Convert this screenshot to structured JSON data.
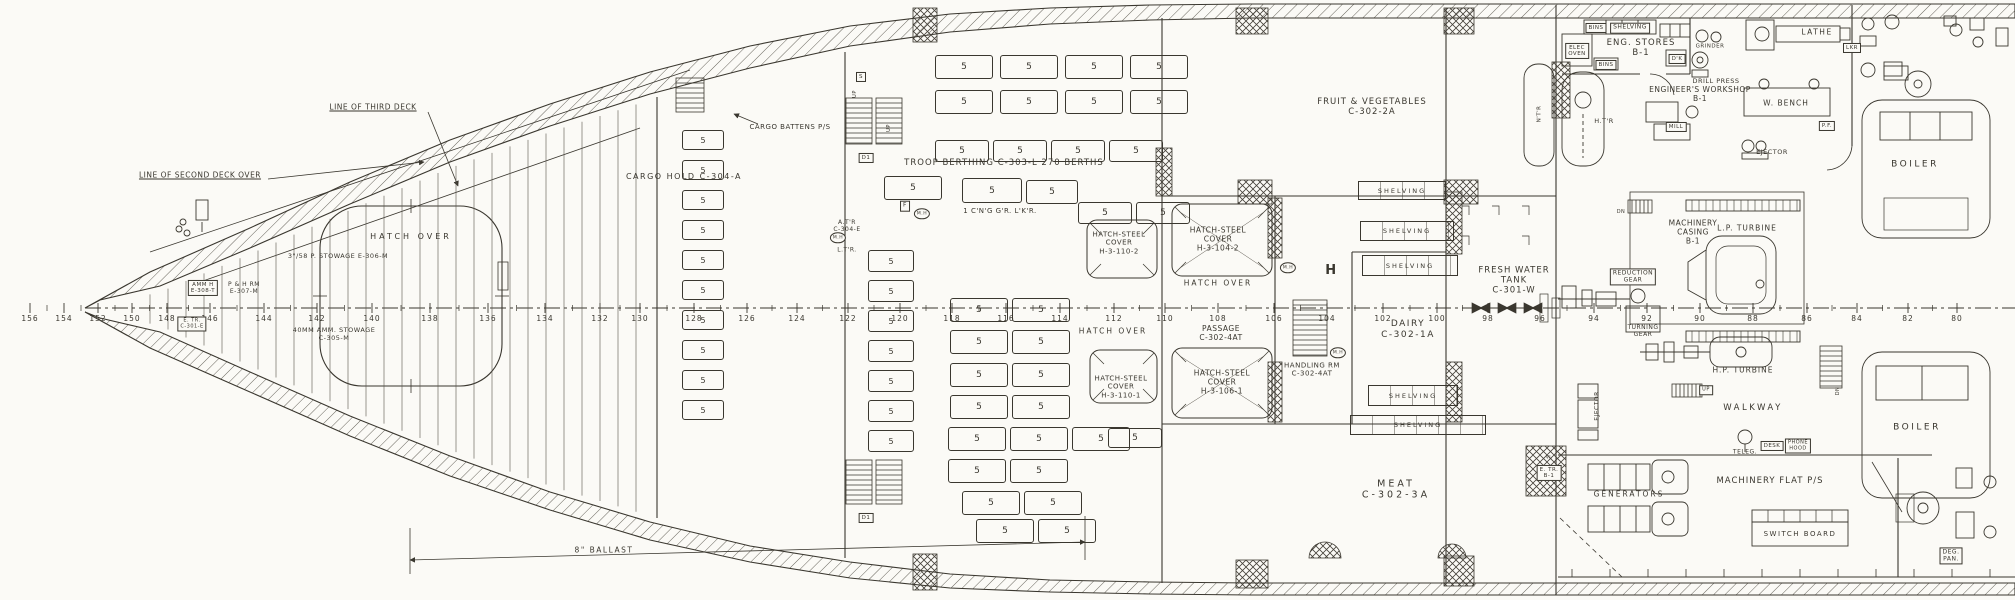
{
  "sheet": {
    "paper": "#fbfaf6",
    "ink": "#3a372f"
  },
  "frame_scale": {
    "centerline_y": 308,
    "numbers": [
      [
        "156",
        30
      ],
      [
        "154",
        64
      ],
      [
        "152",
        98
      ],
      [
        "150",
        132
      ],
      [
        "148",
        167
      ],
      [
        "146",
        210
      ],
      [
        "144",
        264
      ],
      [
        "142",
        317
      ],
      [
        "140",
        372
      ],
      [
        "138",
        430
      ],
      [
        "136",
        488
      ],
      [
        "134",
        545
      ],
      [
        "132",
        600
      ],
      [
        "130",
        640
      ],
      [
        "128",
        694
      ],
      [
        "126",
        747
      ],
      [
        "124",
        797
      ],
      [
        "122",
        848
      ],
      [
        "120",
        900
      ],
      [
        "118",
        952
      ],
      [
        "116",
        1006
      ],
      [
        "114",
        1060
      ],
      [
        "112",
        1114
      ],
      [
        "110",
        1165
      ],
      [
        "108",
        1218
      ],
      [
        "106",
        1274
      ],
      [
        "104",
        1327
      ],
      [
        "102",
        1383
      ],
      [
        "100",
        1437
      ],
      [
        "98",
        1488
      ],
      [
        "96",
        1540
      ],
      [
        "94",
        1594
      ],
      [
        "92",
        1647
      ],
      [
        "90",
        1700
      ],
      [
        "88",
        1753
      ],
      [
        "86",
        1807
      ],
      [
        "84",
        1857
      ],
      [
        "82",
        1908
      ],
      [
        "80",
        1957
      ]
    ]
  },
  "berths": {
    "value": "5",
    "boxes": [
      [
        935,
        55,
        56,
        22
      ],
      [
        1000,
        55,
        56,
        22
      ],
      [
        1065,
        55,
        56,
        22
      ],
      [
        1130,
        55,
        56,
        22
      ],
      [
        935,
        90,
        56,
        22
      ],
      [
        1000,
        90,
        56,
        22
      ],
      [
        1065,
        90,
        56,
        22
      ],
      [
        1130,
        90,
        56,
        22
      ],
      [
        935,
        140,
        52,
        20
      ],
      [
        993,
        140,
        52,
        20
      ],
      [
        1051,
        140,
        52,
        20
      ],
      [
        1109,
        140,
        52,
        20
      ],
      [
        884,
        176,
        56,
        22
      ],
      [
        962,
        178,
        58,
        23
      ],
      [
        1026,
        180,
        50,
        22
      ],
      [
        1078,
        202,
        52,
        20
      ],
      [
        1136,
        202,
        52,
        20
      ],
      [
        682,
        130,
        40,
        18
      ],
      [
        682,
        160,
        40,
        18
      ],
      [
        682,
        190,
        40,
        18
      ],
      [
        682,
        220,
        40,
        18
      ],
      [
        682,
        250,
        40,
        18
      ],
      [
        682,
        280,
        40,
        18
      ],
      [
        682,
        310,
        40,
        18
      ],
      [
        682,
        340,
        40,
        18
      ],
      [
        682,
        370,
        40,
        18
      ],
      [
        682,
        400,
        40,
        18
      ],
      [
        868,
        250,
        44,
        20
      ],
      [
        868,
        280,
        44,
        20
      ],
      [
        868,
        310,
        44,
        20
      ],
      [
        868,
        340,
        44,
        20
      ],
      [
        868,
        370,
        44,
        20
      ],
      [
        868,
        400,
        44,
        20
      ],
      [
        868,
        430,
        44,
        20
      ],
      [
        950,
        298,
        56,
        22
      ],
      [
        1012,
        298,
        56,
        22
      ],
      [
        950,
        330,
        56,
        22
      ],
      [
        1012,
        330,
        56,
        22
      ],
      [
        950,
        363,
        56,
        22
      ],
      [
        1012,
        363,
        56,
        22
      ],
      [
        950,
        395,
        56,
        22
      ],
      [
        1012,
        395,
        56,
        22
      ],
      [
        948,
        427,
        56,
        22
      ],
      [
        1010,
        427,
        56,
        22
      ],
      [
        1072,
        427,
        56,
        22
      ],
      [
        1108,
        428,
        52,
        18
      ],
      [
        948,
        459,
        56,
        22
      ],
      [
        1010,
        459,
        56,
        22
      ],
      [
        962,
        491,
        56,
        22
      ],
      [
        1024,
        491,
        56,
        22
      ],
      [
        976,
        519,
        56,
        22
      ],
      [
        1038,
        519,
        56,
        22
      ]
    ]
  },
  "shelving": {
    "label": "SHELVING",
    "boxes": [
      [
        1358,
        181,
        86,
        17
      ],
      [
        1360,
        221,
        92,
        18
      ],
      [
        1362,
        255,
        94,
        19
      ],
      [
        1368,
        385,
        88,
        19
      ],
      [
        1350,
        415,
        134,
        18
      ]
    ]
  },
  "labels": [
    {
      "name": "line-of-second-deck-label",
      "text": "LINE OF SECOND DECK OVER",
      "x": 200,
      "y": 175,
      "fs": 7.5,
      "ul": true
    },
    {
      "name": "line-of-third-deck-label",
      "text": "LINE OF THIRD DECK",
      "x": 373,
      "y": 107,
      "fs": 7.5,
      "ul": true
    },
    {
      "name": "cargo-battens-label",
      "text": "CARGO BATTENS P/S",
      "x": 790,
      "y": 127,
      "fs": 7
    },
    {
      "name": "cargo-hold-label",
      "text": "CARGO HOLD   C-304-A",
      "x": 684,
      "y": 177,
      "fs": 8,
      "ls": 1.5
    },
    {
      "name": "hatch-over-main-label",
      "text": "HATCH OVER",
      "x": 411,
      "y": 237,
      "fs": 8,
      "ls": 3
    },
    {
      "name": "troop-berthing-label",
      "text": "TROOP BERTHING    C-303-L    270 BERTHS",
      "x": 1004,
      "y": 163,
      "fs": 8.5,
      "ls": 1
    },
    {
      "name": "cleaning-gear-locker-label",
      "text": "1 C'N'G  G'R. L'K'R.",
      "x": 1000,
      "y": 211,
      "fs": 7
    },
    {
      "name": "atr-label",
      "text": "A.T'R\nC-304-E",
      "x": 847,
      "y": 226,
      "fs": 6
    },
    {
      "name": "ltr-label",
      "text": "L.T'R.",
      "x": 847,
      "y": 250,
      "fs": 6
    },
    {
      "name": "hatch-cover-110-2-label",
      "text": "HATCH-STEEL\nCOVER\nH-3-110-2",
      "x": 1119,
      "y": 243,
      "fs": 7
    },
    {
      "name": "hatch-cover-104-2-label",
      "text": "HATCH-STEEL\nCOVER\nH-3-104-2",
      "x": 1218,
      "y": 239,
      "fs": 7.5
    },
    {
      "name": "hatch-over-a-label",
      "text": "HATCH OVER",
      "x": 1218,
      "y": 283,
      "fs": 7.5,
      "ls": 2
    },
    {
      "name": "hatch-over-b-label",
      "text": "HATCH OVER",
      "x": 1113,
      "y": 331,
      "fs": 7.5,
      "ls": 2
    },
    {
      "name": "passage-label",
      "text": "PASSAGE\nC-302-4AT",
      "x": 1221,
      "y": 333,
      "fs": 7.5
    },
    {
      "name": "hatch-cover-110-1-label",
      "text": "HATCH-STEEL\nCOVER\nH-3-110-1",
      "x": 1121,
      "y": 387,
      "fs": 7
    },
    {
      "name": "hatch-cover-106-1-label",
      "text": "HATCH-STEEL\nCOVER\nH-3-106-1",
      "x": 1222,
      "y": 382,
      "fs": 7.5
    },
    {
      "name": "handling-room-label",
      "text": "HANDLING RM\nC-302-4AT",
      "x": 1312,
      "y": 370,
      "fs": 7
    },
    {
      "name": "fruit-vegetables-label",
      "text": "FRUIT & VEGETABLES\nC-302-2A",
      "x": 1372,
      "y": 107,
      "fs": 8.5,
      "ls": 1
    },
    {
      "name": "fresh-water-tank-label",
      "text": "FRESH WATER\nTANK\nC-301-W",
      "x": 1514,
      "y": 281,
      "fs": 8.5,
      "ls": 1
    },
    {
      "name": "dairy-label",
      "text": "DAIRY\nC-302-1A",
      "x": 1408,
      "y": 330,
      "fs": 9,
      "ls": 1.5
    },
    {
      "name": "meat-label",
      "text": "MEAT\nC-302-3A",
      "x": 1396,
      "y": 490,
      "fs": 9.5,
      "ls": 3
    },
    {
      "name": "ballast-label",
      "text": "8\" BALLAST",
      "x": 604,
      "y": 550,
      "fs": 7.5,
      "ls": 1.5
    },
    {
      "name": "stowage-358-label",
      "text": "3\"/58 P. STOWAGE   E-306-M",
      "x": 338,
      "y": 257,
      "fs": 6.5
    },
    {
      "name": "amm-stowage-label",
      "text": "40MM AMM. STOWAGE\nC-305-M",
      "x": 334,
      "y": 335,
      "fs": 6.5
    },
    {
      "name": "amm-hoist-label",
      "text": "AMM H\nE-308-T",
      "x": 203,
      "y": 288,
      "fs": 5.5,
      "boxed": true
    },
    {
      "name": "ph-room-label",
      "text": "P & H RM\nE-307-M",
      "x": 244,
      "y": 288,
      "fs": 6
    },
    {
      "name": "escape-trunk-bow-label",
      "text": "E. TR.\nC-301-E",
      "x": 192,
      "y": 324,
      "fs": 5,
      "boxed": true
    },
    {
      "name": "eng-stores-label",
      "text": "ENG. STORES\nB-1",
      "x": 1641,
      "y": 48,
      "fs": 8.5,
      "ls": 1
    },
    {
      "name": "bins-top-label",
      "text": "BINS",
      "x": 1596,
      "y": 28,
      "fs": 5.5,
      "boxed": true
    },
    {
      "name": "shelving-top-label",
      "text": "SHELVING",
      "x": 1630,
      "y": 28,
      "fs": 6,
      "boxed": true
    },
    {
      "name": "elec-oven-label",
      "text": "ELEC\nOVEN",
      "x": 1577,
      "y": 51,
      "fs": 5.5,
      "boxed": true
    },
    {
      "name": "bins-2-label",
      "text": "BINS",
      "x": 1606,
      "y": 65,
      "fs": 5.5,
      "boxed": true
    },
    {
      "name": "desk-dk-label",
      "text": "D'K",
      "x": 1677,
      "y": 59,
      "fs": 5.5,
      "boxed": true
    },
    {
      "name": "grinder-label",
      "text": "GRINDER",
      "x": 1710,
      "y": 47,
      "fs": 5.5
    },
    {
      "name": "drill-press-label",
      "text": "DRILL PRESS",
      "x": 1716,
      "y": 82,
      "fs": 6.5
    },
    {
      "name": "lathe-label",
      "text": "LATHE",
      "x": 1817,
      "y": 32,
      "fs": 7.5,
      "ls": 1.5
    },
    {
      "name": "lkr-label",
      "text": "LKR",
      "x": 1852,
      "y": 48,
      "fs": 5.5,
      "boxed": true
    },
    {
      "name": "engineers-workshop-label",
      "text": "ENGINEER'S WORKSHOP\nB-1",
      "x": 1700,
      "y": 94,
      "fs": 7.5
    },
    {
      "name": "w-bench-label",
      "text": "W. BENCH",
      "x": 1786,
      "y": 103,
      "fs": 7.5,
      "ls": 1
    },
    {
      "name": "heater-label",
      "text": "H.T'R",
      "x": 1604,
      "y": 122,
      "fs": 6.5
    },
    {
      "name": "mill-label",
      "text": "MILL",
      "x": 1676,
      "y": 127,
      "fs": 5.5,
      "boxed": true
    },
    {
      "name": "pf-label",
      "text": "P.F.",
      "x": 1827,
      "y": 126,
      "fs": 5.5,
      "boxed": true
    },
    {
      "name": "ejector-top-label",
      "text": "EJECTOR",
      "x": 1772,
      "y": 153,
      "fs": 6.5
    },
    {
      "name": "boiler-top-label",
      "text": "BOILER",
      "x": 1915,
      "y": 165,
      "fs": 9,
      "ls": 2.5
    },
    {
      "name": "boiler-bottom-label",
      "text": "BOILER",
      "x": 1917,
      "y": 428,
      "fs": 9,
      "ls": 2.5
    },
    {
      "name": "machinery-casing-label",
      "text": "MACHINERY\nCASING\nB-1",
      "x": 1693,
      "y": 232,
      "fs": 7.5
    },
    {
      "name": "lp-turbine-label",
      "text": "L.P. TURBINE",
      "x": 1747,
      "y": 228,
      "fs": 7.5,
      "ls": 1
    },
    {
      "name": "reduction-gear-label",
      "text": "REDUCTION\nGEAR",
      "x": 1633,
      "y": 277,
      "fs": 6,
      "boxed": true
    },
    {
      "name": "turning-gear-label",
      "text": "TURNING\nGEAR",
      "x": 1643,
      "y": 331,
      "fs": 6
    },
    {
      "name": "hp-turbine-label",
      "text": "H.P. TURBINE",
      "x": 1743,
      "y": 370,
      "fs": 7.5,
      "ls": 1
    },
    {
      "name": "walkway-label",
      "text": "WALKWAY",
      "x": 1753,
      "y": 408,
      "fs": 8.5,
      "ls": 2.5
    },
    {
      "name": "ejector-vert-label",
      "text": "EJECTOR",
      "x": 1597,
      "y": 406,
      "fs": 6,
      "rot": -90
    },
    {
      "name": "teleg-label",
      "text": "TELEG.",
      "x": 1745,
      "y": 452,
      "fs": 6
    },
    {
      "name": "desk-label",
      "text": "DESK",
      "x": 1772,
      "y": 446,
      "fs": 5.5,
      "boxed": true
    },
    {
      "name": "phone-hood-label",
      "text": "PHONE\nHOOD",
      "x": 1798,
      "y": 446,
      "fs": 5,
      "boxed": true
    },
    {
      "name": "machinery-flat-label",
      "text": "MACHINERY FLAT    P/S",
      "x": 1770,
      "y": 481,
      "fs": 8.5,
      "ls": 1
    },
    {
      "name": "generators-label",
      "text": "GENERATORS",
      "x": 1629,
      "y": 494,
      "fs": 7.5,
      "ls": 2
    },
    {
      "name": "switch-board-label",
      "text": "SWITCH BOARD",
      "x": 1800,
      "y": 534,
      "fs": 7,
      "ls": 1.5
    },
    {
      "name": "deg-pan-label",
      "text": "DEG.\nPAN.",
      "x": 1951,
      "y": 556,
      "fs": 6,
      "boxed": true
    },
    {
      "name": "escape-trunk-b1-label",
      "text": "E. TR.\nB-1",
      "x": 1549,
      "y": 473,
      "fs": 5.5,
      "boxed": true
    },
    {
      "name": "vl-label",
      "text": "VL",
      "x": 1549,
      "y": 458,
      "fs": 4.5
    },
    {
      "name": "up-stair-a-label",
      "text": "UP",
      "x": 855,
      "y": 94,
      "fs": 5,
      "rot": -90
    },
    {
      "name": "up-stair-b-label",
      "text": "UP",
      "x": 889,
      "y": 128,
      "fs": 5,
      "rot": -90
    },
    {
      "name": "dn-stair-right-label",
      "text": "DN",
      "x": 1838,
      "y": 391,
      "fs": 5,
      "rot": -90
    },
    {
      "name": "up-hp-label",
      "text": "UP",
      "x": 1706,
      "y": 390,
      "fs": 5,
      "boxed": true
    },
    {
      "name": "dn-casing-label",
      "text": "DN",
      "x": 1621,
      "y": 212,
      "fs": 5
    },
    {
      "name": "door-d1-top-label",
      "text": "D1",
      "x": 866,
      "y": 158,
      "fs": 5.5,
      "boxed": true
    },
    {
      "name": "door-d1-bottom-label",
      "text": "D1",
      "x": 866,
      "y": 518,
      "fs": 5.5,
      "boxed": true
    },
    {
      "name": "f-tag-label",
      "text": "F",
      "x": 905,
      "y": 206,
      "fs": 6,
      "boxed": true
    },
    {
      "name": "s-tag-label",
      "text": "S",
      "x": 861,
      "y": 77,
      "fs": 5.5,
      "boxed": true
    },
    {
      "name": "h-mark-label",
      "text": "H",
      "x": 1331,
      "y": 271,
      "fs": 13,
      "bold": true
    },
    {
      "name": "manhole-1-label",
      "text": "M.H",
      "x": 922,
      "y": 214,
      "fs": 4.5,
      "circled": true
    },
    {
      "name": "manhole-2-label",
      "text": "M.H",
      "x": 838,
      "y": 238,
      "fs": 4.5,
      "circled": true
    },
    {
      "name": "manhole-3-label",
      "text": "M.H",
      "x": 1288,
      "y": 268,
      "fs": 4.5,
      "circled": true
    },
    {
      "name": "manhole-4-label",
      "text": "M.H",
      "x": 1338,
      "y": 353,
      "fs": 4.5,
      "circled": true
    },
    {
      "name": "ntr-label",
      "text": "N'T'R",
      "x": 1540,
      "y": 114,
      "fs": 5.5,
      "rot": -90
    }
  ]
}
